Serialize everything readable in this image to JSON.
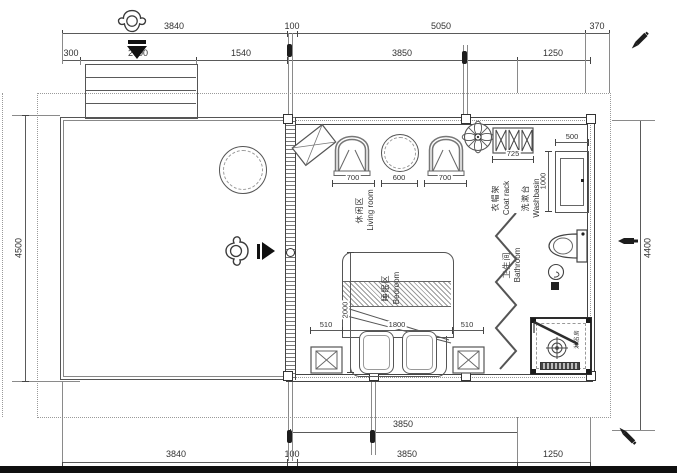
{
  "meta": {
    "type": "architectural floor plan"
  },
  "colors": {
    "line": "#444444",
    "dim_text": "#323232",
    "background": "#ffffff",
    "marker": "#1d1d1d"
  },
  "dims": {
    "top1": {
      "a": "3840",
      "b": "100",
      "c": "5050",
      "d": "370"
    },
    "top2": {
      "a": "300",
      "b": "2000",
      "c": "1540",
      "d": "3850",
      "e": "1250"
    },
    "left": "4500",
    "right": "4400",
    "bottom1": {
      "a": "3850"
    },
    "bottom2": {
      "a": "3840",
      "b": "100",
      "c": "3850",
      "d": "1250"
    },
    "furniture": {
      "chair_left": "700",
      "round_table": "600",
      "chair_right": "700",
      "coat_rack": "725",
      "washbasin_width": "500",
      "washbasin_depth": "1000",
      "bed_side_left": "510",
      "bed_width": "1800",
      "bed_side_right": "510",
      "bed_length": "2000"
    }
  },
  "rooms": {
    "living": {
      "zh": "休闲区",
      "en": "Living room"
    },
    "bedroom": {
      "zh": "睡眠区",
      "en": "Bedroom"
    },
    "bathroom": {
      "zh": "卫生间",
      "en": "Bathroom"
    },
    "washbasin": {
      "zh": "洗漱台",
      "en": "Washbasin"
    },
    "coat_rack": {
      "zh": "衣帽架",
      "en": "Coat rack"
    },
    "shower": {
      "zh": "淋浴房",
      "en": ""
    }
  }
}
